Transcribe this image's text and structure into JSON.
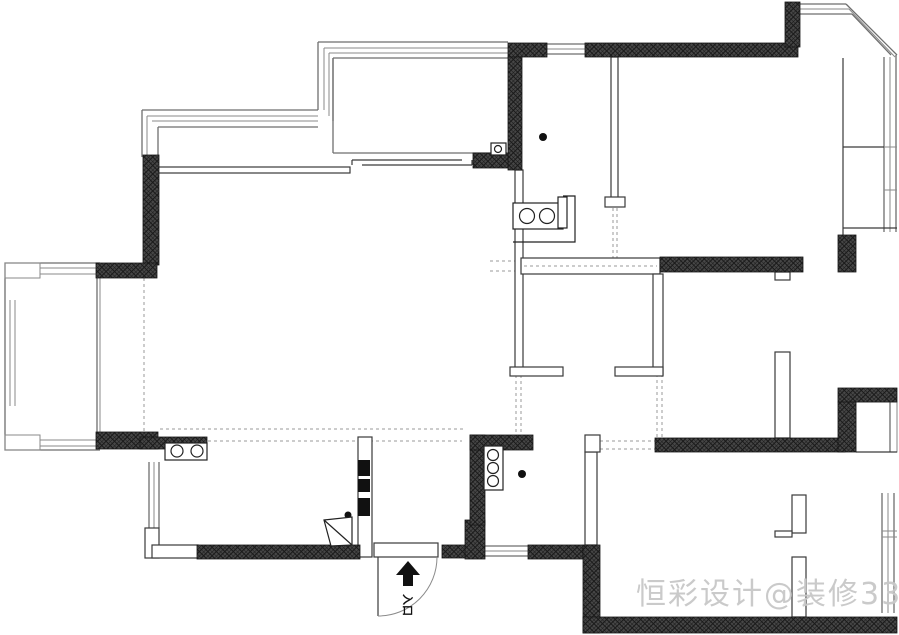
{
  "plan": {
    "kind": "residential floor plan",
    "rooms_labeled": false
  },
  "watermark": {
    "text": "恒彩设计@装修33天",
    "color": "#c8c8c8"
  },
  "entry": {
    "label": "入口"
  },
  "colors": {
    "background": "#ffffff",
    "wall_fill": "#474747",
    "wall_hatch": "#1a1a1a",
    "thin_wall_line": "#3a3a3a",
    "window_line": "#6e6e6e",
    "dashed_line": "#999999",
    "fixture_line": "#222222",
    "marker_fill": "#111111",
    "watermark_text": "#c8c8c8"
  },
  "icons": {
    "entry-arrow": "▲",
    "floor-drain": "●",
    "stove-burner": "○",
    "sink-basin": "○",
    "door-swing": "quarter-arc",
    "electrical-box-marker": "▮",
    "gas-meter": "▢○"
  }
}
